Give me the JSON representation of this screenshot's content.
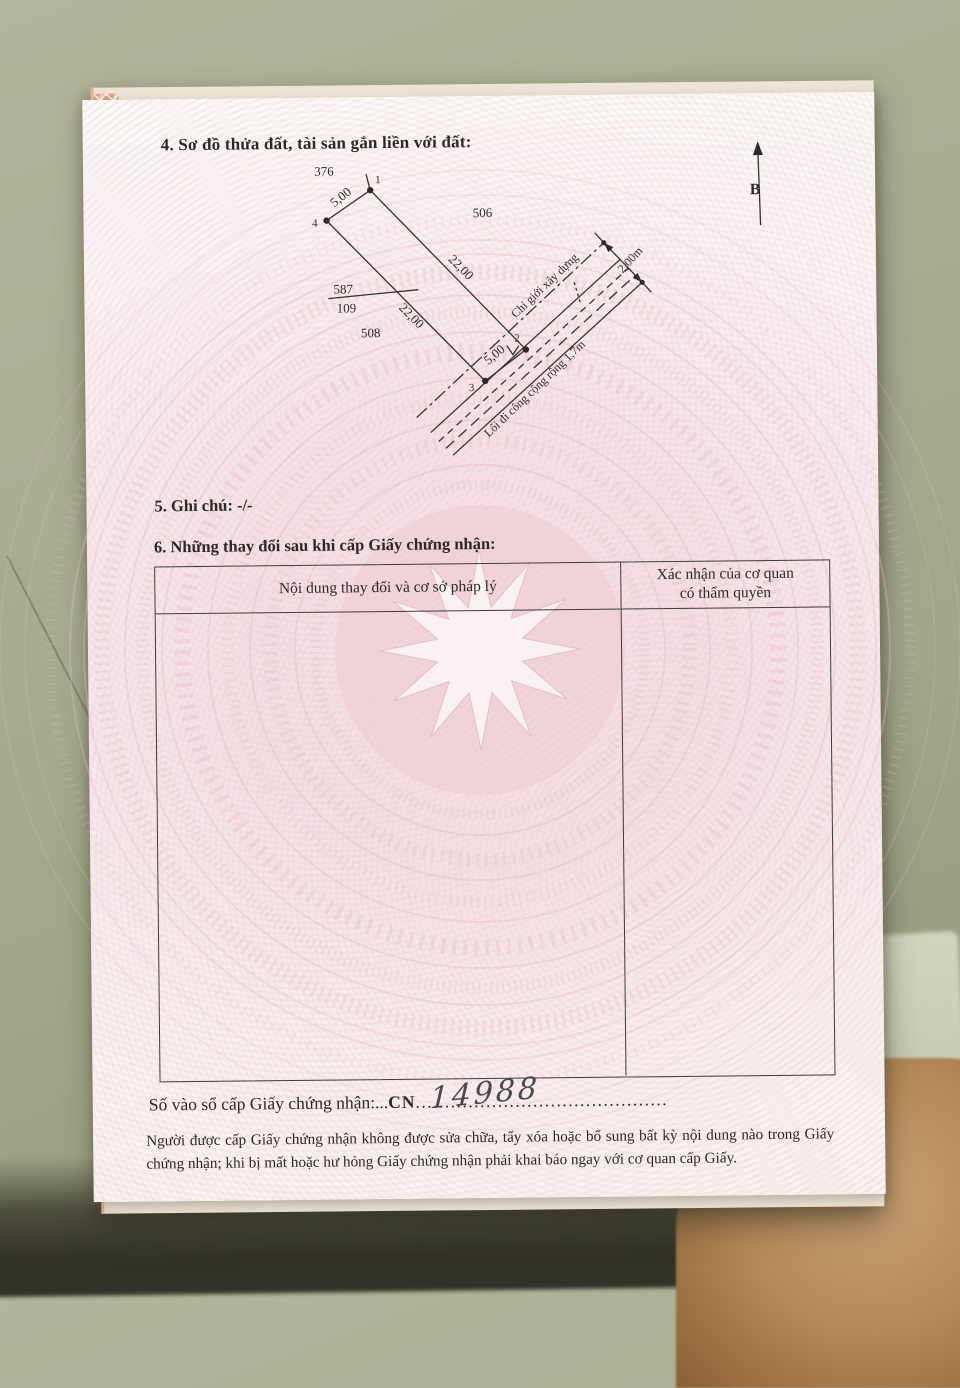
{
  "colors": {
    "paper_pink": "#f6ebed",
    "guilloche_pink": "#e9bcc6",
    "salmon_edge": "#e79b7c",
    "floor_olive": "#a2a789",
    "skin_tone": "#b68a59",
    "ink": "#2b2926"
  },
  "document": {
    "section4": {
      "title": "4. Sơ đồ thửa đất, tài sản gắn liền với đất:"
    },
    "diagram": {
      "north_label": "B",
      "parcels": {
        "top": "376",
        "right": "506",
        "bottom": "508",
        "current_number": "587",
        "current_area": "109"
      },
      "vertices": {
        "v1": "1",
        "v2": "2",
        "v3": "3",
        "v4": "4"
      },
      "dims": {
        "top_edge": "5,00",
        "right_edge": "22,00",
        "left_edge": "22,00",
        "bottom_edge": "5,00",
        "road_width": "2,00m"
      },
      "construction_boundary": "Chỉ giới xây dựng",
      "road_label": "Lối đi công cộng rộng 1,7m"
    },
    "section5": {
      "text": "5. Ghi chú: -/-"
    },
    "section6": {
      "title": "6. Những thay đổi sau khi cấp Giấy chứng nhận:",
      "table": {
        "col1_header": "Nội dung thay đổi và cơ sở pháp lý",
        "col2_header_line1": "Xác nhận của cơ quan",
        "col2_header_line2": "có thẩm quyền"
      }
    },
    "serial": {
      "label": "Số vào sổ cấp Giấy chứng nhận:",
      "dots1": "...",
      "code": "CN",
      "dots2": "...........................................",
      "number": "14988"
    },
    "notice": "Người được cấp Giấy chứng nhận không được sửa chữa, tẩy xóa hoặc bổ sung bất kỳ nội dung nào trong Giấy chứng nhận; khi bị mất hoặc hư hỏng Giấy chứng nhận phải khai báo ngay với cơ quan cấp Giấy."
  }
}
